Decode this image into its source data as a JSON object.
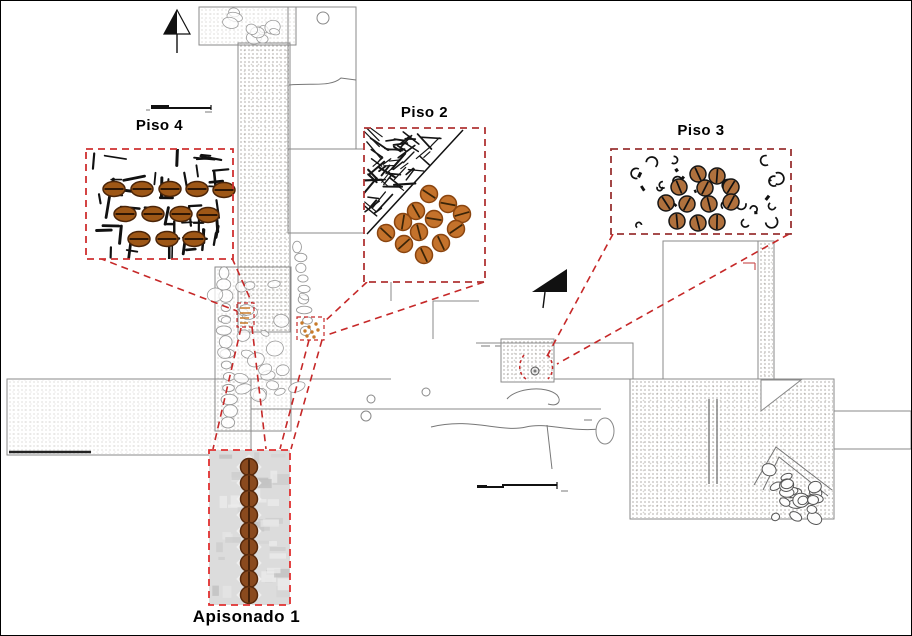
{
  "figure": {
    "type": "archaeological-excavation-plan",
    "background": "#ffffff"
  },
  "colors": {
    "leader_red": "#c62828",
    "plan_stroke": "#8a8a8a",
    "stone_stroke": "#9a9a9a",
    "cobble_stroke": "#555555",
    "black_ink": "#111111",
    "micro_mark": "#a0a0a0"
  },
  "labels": {
    "piso4": "Piso 4",
    "piso2": "Piso 2",
    "piso3": "Piso 3",
    "apisonado1": "Apisonado 1"
  },
  "insets": [
    {
      "id": "piso4",
      "label": "Piso 4",
      "box": [
        85,
        148,
        147,
        110
      ],
      "bg": "strokes",
      "bg_fill": "#ffffff",
      "border_color": "#cf3030",
      "seed_style": {
        "shape": "ellipse",
        "rx": 11,
        "ry": 7.5,
        "fill": "#9e5716",
        "stroke": "#4a2408",
        "line": "horizontal",
        "line_color": "#2e1604"
      },
      "seeds": [
        [
          113,
          188
        ],
        [
          141,
          188
        ],
        [
          169,
          188
        ],
        [
          196,
          188
        ],
        [
          223,
          189
        ],
        [
          124,
          213
        ],
        [
          152,
          213
        ],
        [
          180,
          213
        ],
        [
          207,
          214
        ],
        [
          138,
          238
        ],
        [
          166,
          238
        ],
        [
          193,
          238
        ]
      ]
    },
    {
      "id": "piso2",
      "label": "Piso 2",
      "box": [
        363,
        127,
        121,
        154
      ],
      "bg": "hatch",
      "bg_fill": "#ffffff",
      "border_color": "#b03434",
      "diagonal": [
        366,
        233,
        462,
        129
      ],
      "seed_style": {
        "shape": "circle",
        "r": 8.5,
        "fill": "#c4722b",
        "stroke": "#8a4510",
        "line": "random",
        "line_color": "#3a2408"
      },
      "seeds": [
        [
          428,
          193
        ],
        [
          447,
          203
        ],
        [
          415,
          210
        ],
        [
          402,
          221
        ],
        [
          433,
          218
        ],
        [
          461,
          213
        ],
        [
          385,
          232
        ],
        [
          418,
          231
        ],
        [
          455,
          228
        ],
        [
          403,
          243
        ],
        [
          440,
          242
        ],
        [
          423,
          254
        ]
      ]
    },
    {
      "id": "piso3",
      "label": "Piso 3",
      "box": [
        610,
        148,
        180,
        85
      ],
      "bg": "specks",
      "bg_fill": "#ffffff",
      "border_color": "#993333",
      "seed_style": {
        "shape": "circle",
        "r": 8,
        "fill": "#b0713d",
        "stroke": "#151515",
        "line": "steep",
        "line_color": "#111111"
      },
      "seeds": [
        [
          697,
          173
        ],
        [
          716,
          175
        ],
        [
          678,
          186
        ],
        [
          704,
          187
        ],
        [
          730,
          186
        ],
        [
          665,
          202
        ],
        [
          686,
          203
        ],
        [
          708,
          203
        ],
        [
          730,
          201
        ],
        [
          676,
          220
        ],
        [
          697,
          222
        ],
        [
          716,
          221
        ]
      ]
    },
    {
      "id": "apisonado1",
      "label": "Apisonado 1",
      "box": [
        208,
        449,
        81,
        155
      ],
      "bg": "photo",
      "bg_fill": "#dcdcdc",
      "border_color": "#e03030",
      "seed_style": {
        "shape": "circle",
        "r": 8.5,
        "fill": "#8a4a1e",
        "stroke": "#58290b",
        "line": "vertical",
        "line_color": "#3a1c06"
      },
      "seeds": [
        [
          248,
          466
        ],
        [
          248,
          482
        ],
        [
          248,
          498
        ],
        [
          248,
          514
        ],
        [
          248,
          530
        ],
        [
          248,
          546
        ],
        [
          248,
          562
        ],
        [
          248,
          578
        ],
        [
          248,
          594
        ]
      ]
    }
  ],
  "leader_lines": [
    [
      98,
      257,
      236,
      310
    ],
    [
      231,
      257,
      251,
      302
    ],
    [
      366,
      281,
      323,
      321
    ],
    [
      483,
      281,
      326,
      334
    ],
    [
      612,
      233,
      545,
      357
    ],
    [
      788,
      233,
      556,
      363
    ],
    [
      240,
      327,
      212,
      448
    ],
    [
      251,
      326,
      265,
      448
    ],
    [
      308,
      339,
      279,
      448
    ],
    [
      321,
      339,
      290,
      448
    ]
  ],
  "targets": {
    "t1_box": [
      236,
      302,
      17,
      24
    ],
    "t1_marks": [
      [
        239,
        307,
        249,
        307
      ],
      [
        239,
        312,
        250,
        312
      ],
      [
        239,
        317,
        248,
        317
      ],
      [
        239,
        322,
        247,
        322
      ]
    ],
    "t2_box": [
      296,
      316,
      27,
      23
    ],
    "t2_dots": [
      [
        301,
        322
      ],
      [
        308,
        326
      ],
      [
        315,
        323
      ],
      [
        304,
        330
      ],
      [
        311,
        331
      ],
      [
        317,
        329
      ],
      [
        306,
        335
      ],
      [
        313,
        336
      ]
    ],
    "t3_arcs": [
      "M523,354 C517,362 517,372 525,378",
      "M547,354 C553,362 553,372 547,378"
    ],
    "t3_circle": [
      534,
      370,
      4
    ],
    "mark_color": "#c87a2a"
  },
  "north_arrows": [
    {
      "id": "north-arrow-top",
      "tip": [
        176,
        9
      ],
      "left": [
        163,
        33
      ],
      "right": [
        189,
        33
      ],
      "stem": [
        176,
        33,
        176,
        52
      ],
      "style": "half"
    },
    {
      "id": "north-arrow-center",
      "tip": [
        566,
        268
      ],
      "left": [
        531,
        291
      ],
      "right": [
        566,
        291
      ],
      "stem": [
        544,
        291,
        542,
        307
      ],
      "style": "solid"
    }
  ],
  "scale_bars": [
    {
      "id": "scale-bar-topleft",
      "path": "M150,107 L210,107",
      "block": [
        150,
        104,
        18,
        3
      ],
      "tick": [
        210,
        104,
        210,
        109
      ]
    },
    {
      "id": "scale-bar-bottom",
      "path": "M476,486 L502,486 L502,484 L556,484",
      "block": [
        476,
        484,
        10,
        3
      ],
      "tick": [
        556,
        481,
        556,
        488
      ]
    }
  ],
  "plan": {
    "rects": [
      {
        "x": 198,
        "y": 6,
        "w": 97,
        "h": 38,
        "name": "unit-topleft"
      },
      {
        "x": 287,
        "y": 6,
        "w": 68,
        "h": 142,
        "name": "unit-top"
      },
      {
        "x": 287,
        "y": 148,
        "w": 103,
        "h": 84,
        "name": "unit-top2"
      },
      {
        "x": 6,
        "y": 378,
        "w": 244,
        "h": 76,
        "name": "left-arm"
      },
      {
        "x": 553,
        "y": 342,
        "w": 79,
        "h": 36,
        "name": "unit-right-center"
      },
      {
        "x": 500,
        "y": 338,
        "w": 53,
        "h": 43,
        "name": "unit-target-piso3"
      },
      {
        "x": 629,
        "y": 378,
        "w": 204,
        "h": 140,
        "name": "block-right"
      },
      {
        "x": 833,
        "y": 410,
        "w": 77,
        "h": 38,
        "name": "right-arm"
      },
      {
        "x": 662,
        "y": 240,
        "w": 95,
        "h": 138,
        "name": "unit-right-tall"
      },
      {
        "x": 757,
        "y": 240,
        "w": 16,
        "h": 138,
        "name": "strip-right"
      },
      {
        "x": 237,
        "y": 42,
        "w": 52,
        "h": 289,
        "name": "strip-central"
      },
      {
        "x": 214,
        "y": 266,
        "w": 76,
        "h": 164,
        "name": "column-central"
      }
    ],
    "lines": [
      [
        250,
        408,
        600,
        408
      ],
      [
        250,
        378,
        390,
        378
      ],
      [
        290,
        232,
        390,
        232
      ],
      [
        390,
        232,
        390,
        300
      ],
      [
        432,
        338,
        432,
        300
      ],
      [
        432,
        300,
        478,
        300
      ],
      [
        214,
        430,
        290,
        430
      ],
      [
        475,
        342,
        553,
        342
      ]
    ],
    "thick_lines": [
      [
        8,
        451,
        90,
        451
      ]
    ],
    "curves": [
      "M288,84 C312,82 330,86 340,77 L355,79",
      "M430,426 C470,416 500,432 525,426 C545,421 565,431 600,428",
      "M506,398 C515,387 545,384 556,394 C561,400 557,406 547,403",
      "M546,424 L551,468",
      "M753,484 L775,446 L831,489",
      "M762,489 L778,456 L827,495"
    ],
    "circles": [
      [
        322,
        17,
        6
      ],
      [
        370,
        398,
        4
      ],
      [
        425,
        391,
        4
      ],
      [
        365,
        415,
        5
      ]
    ],
    "ellipses": [
      [
        604,
        430,
        9,
        13
      ]
    ],
    "wall_lines": [
      [
        708,
        398,
        708,
        483
      ],
      [
        716,
        398,
        716,
        483
      ]
    ],
    "white_triangle": [
      [
        760,
        379
      ],
      [
        800,
        379
      ],
      [
        760,
        410
      ]
    ],
    "red_ticks": [
      [
        742,
        262,
        754,
        262
      ],
      [
        754,
        262,
        754,
        269
      ]
    ],
    "textures": [
      {
        "x": 199,
        "y": 7,
        "w": 95,
        "h": 36,
        "cls": "tx-stipple-faint"
      },
      {
        "x": 238,
        "y": 43,
        "w": 50,
        "h": 287,
        "cls": "tx-stipple"
      },
      {
        "x": 7,
        "y": 379,
        "w": 242,
        "h": 74,
        "cls": "tx-stipple-faint"
      },
      {
        "x": 630,
        "y": 379,
        "w": 202,
        "h": 138,
        "cls": "tx-stipple"
      },
      {
        "x": 758,
        "y": 241,
        "w": 14,
        "h": 136,
        "cls": "tx-stipple"
      },
      {
        "x": 501,
        "y": 339,
        "w": 51,
        "h": 41,
        "cls": "tx-stipple"
      },
      {
        "x": 215,
        "y": 267,
        "w": 74,
        "h": 162,
        "cls": "tx-stipple-faint"
      }
    ],
    "stone_chains": [
      {
        "x": 298,
        "y": 246,
        "dx": 1,
        "dy": 10.5,
        "n": 9,
        "rx": 6,
        "ry": 4.5
      },
      {
        "x": 222,
        "y": 272,
        "dx": 0.5,
        "dy": 11.5,
        "n": 14,
        "rx": 6.5,
        "ry": 5
      }
    ],
    "stone_fields": [
      {
        "x": 753,
        "y": 463,
        "w": 78,
        "h": 52,
        "n": 22,
        "rmin": 4,
        "rmax": 8,
        "dark": true,
        "name": "cobbles"
      },
      {
        "x": 202,
        "y": 9,
        "w": 90,
        "h": 32,
        "n": 10,
        "rmin": 4,
        "rmax": 8,
        "dark": false,
        "name": "stones-topleft"
      },
      {
        "x": 218,
        "y": 270,
        "w": 68,
        "h": 156,
        "n": 26,
        "rmin": 4,
        "rmax": 9,
        "dark": false,
        "name": "stones-column"
      }
    ],
    "micro_marks": [
      [
        145,
        108,
        4,
        2
      ],
      [
        204,
        110,
        7,
        2
      ],
      [
        480,
        344,
        9,
        2
      ],
      [
        494,
        344,
        6,
        2
      ],
      [
        583,
        418,
        8,
        2
      ],
      [
        560,
        489,
        7,
        2
      ]
    ]
  },
  "decor": {
    "piso4_strokes": 55,
    "piso2_hatch": 65,
    "piso3_specks": 30,
    "apisonado_blotches": 42,
    "seed": 7
  }
}
